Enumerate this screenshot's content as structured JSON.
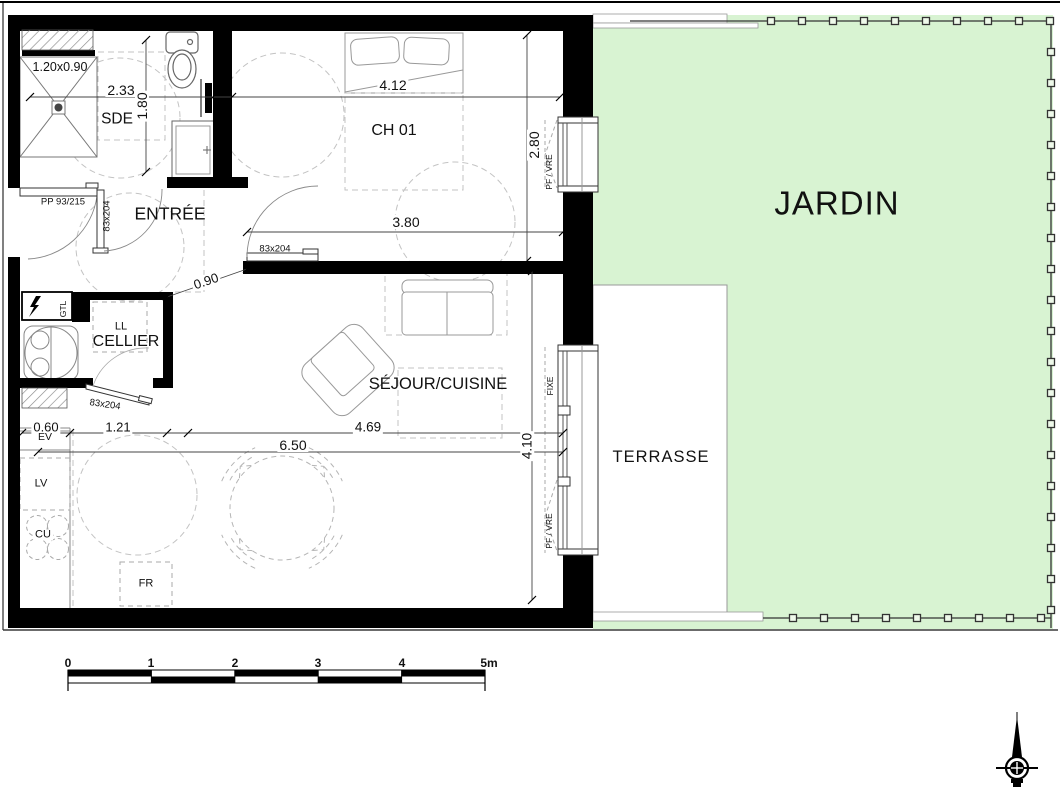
{
  "title": "Plan de logement",
  "rooms": [
    {
      "name": "room-sde",
      "text": "SDE",
      "x": 117,
      "y": 119,
      "size": 15.5
    },
    {
      "name": "room-entree",
      "text": "ENTRÉE",
      "x": 170,
      "y": 214,
      "size": 17.5
    },
    {
      "name": "room-ch01",
      "text": "CH 01",
      "x": 394,
      "y": 131,
      "size": 16
    },
    {
      "name": "room-cellier",
      "text": "CELLIER",
      "x": 126,
      "y": 342,
      "size": 16
    },
    {
      "name": "room-sejour-cuisine",
      "text": "SÉJOUR/CUISINE",
      "x": 438,
      "y": 384,
      "size": 16.5
    },
    {
      "name": "room-terrasse",
      "text": "TERRASSE",
      "x": 661,
      "y": 457,
      "size": 16.5,
      "ls": 1
    },
    {
      "name": "room-jardin",
      "text": "JARDIN",
      "x": 837,
      "y": 203,
      "size": 33,
      "ls": 1
    }
  ],
  "dim_labels": [
    {
      "name": "dim-shower",
      "text": "1.20x0.90",
      "x": 60,
      "y": 67,
      "size": 12.5
    },
    {
      "name": "dim-2-33",
      "text": "2.33",
      "x": 121,
      "y": 90,
      "size": 14,
      "bg": true
    },
    {
      "name": "dim-1-80",
      "text": "1.80",
      "x": 142,
      "y": 106,
      "rot": -90,
      "size": 14,
      "bg": true
    },
    {
      "name": "dim-4-12",
      "text": "4.12",
      "x": 393,
      "y": 85,
      "size": 14,
      "bg": true
    },
    {
      "name": "dim-2-80",
      "text": "2.80",
      "x": 534,
      "y": 145,
      "rot": -90,
      "size": 14,
      "bg": true
    },
    {
      "name": "dim-3-80",
      "text": "3.80",
      "x": 406,
      "y": 222,
      "size": 14,
      "bg": true
    },
    {
      "name": "dim-0-90",
      "text": "0.90",
      "x": 206,
      "y": 281,
      "rot": -19,
      "size": 13,
      "bg": true
    },
    {
      "name": "dim-0-60",
      "text": "0.60",
      "x": 46,
      "y": 427,
      "size": 13,
      "bg": true
    },
    {
      "name": "dim-1-21",
      "text": "1.21",
      "x": 118,
      "y": 427,
      "size": 13,
      "bg": true
    },
    {
      "name": "dim-4-69",
      "text": "4.69",
      "x": 368,
      "y": 427,
      "size": 13.5,
      "bg": true
    },
    {
      "name": "dim-6-50",
      "text": "6.50",
      "x": 293,
      "y": 445,
      "size": 14,
      "bg": true
    },
    {
      "name": "dim-4-10",
      "text": "4.10",
      "x": 527,
      "y": 446,
      "rot": -90,
      "size": 13.5,
      "bg": true
    }
  ],
  "door_labels": [
    {
      "name": "door-pp",
      "text": "PP 93/215",
      "x": 63,
      "y": 202,
      "size": 9.5
    },
    {
      "name": "door-sde",
      "text": "83x204",
      "x": 107,
      "y": 216,
      "rot": -90,
      "size": 9.5
    },
    {
      "name": "door-ch01",
      "text": "83x204",
      "x": 275,
      "y": 249,
      "size": 9.5
    },
    {
      "name": "door-cellier",
      "text": "83x204",
      "x": 105,
      "y": 405,
      "rot": 8,
      "size": 9.5
    }
  ],
  "fixture_labels": [
    {
      "name": "fixture-gtl",
      "text": "GTL",
      "x": 63,
      "y": 309,
      "rot": -90,
      "size": 8.5
    },
    {
      "name": "fixture-ll",
      "text": "LL",
      "x": 121,
      "y": 327,
      "size": 11
    },
    {
      "name": "fixture-ev",
      "text": "EV",
      "x": 45,
      "y": 437,
      "size": 10.5,
      "bg": true
    },
    {
      "name": "fixture-lv",
      "text": "LV",
      "x": 41,
      "y": 484,
      "size": 11
    },
    {
      "name": "fixture-cu",
      "text": "CU",
      "x": 43,
      "y": 535,
      "size": 11,
      "bg": true
    },
    {
      "name": "fixture-fr",
      "text": "FR",
      "x": 146,
      "y": 584,
      "size": 11
    }
  ],
  "window_labels": [
    {
      "name": "window-ch01-type",
      "text": "PF / VRE",
      "x": 549,
      "y": 172,
      "rot": -90,
      "size": 8.5
    },
    {
      "name": "window-sejour-fixe",
      "text": "FIXE",
      "x": 550,
      "y": 386,
      "rot": -90,
      "size": 8.5
    },
    {
      "name": "window-sejour-type",
      "text": "PF / VRE",
      "x": 549,
      "y": 531,
      "rot": -90,
      "size": 8.5
    }
  ],
  "scale_bar": {
    "x": 68,
    "y": 670,
    "meter_px": 83.4,
    "row_h": 6.5,
    "labels": [
      {
        "name": "scale-0",
        "text": "0",
        "x": 68,
        "y": 663
      },
      {
        "name": "scale-1",
        "text": "1",
        "x": 151,
        "y": 663
      },
      {
        "name": "scale-2",
        "text": "2",
        "x": 235,
        "y": 663
      },
      {
        "name": "scale-3",
        "text": "3",
        "x": 318,
        "y": 663
      },
      {
        "name": "scale-4",
        "text": "4",
        "x": 402,
        "y": 663
      },
      {
        "name": "scale-5m",
        "text": "5m",
        "x": 489,
        "y": 663
      }
    ]
  },
  "dimension_lines": [
    {
      "x1": 30,
      "y1": 97,
      "x2": 560,
      "y2": 97,
      "ticks": [
        [
          30,
          97
        ],
        [
          213,
          97
        ],
        [
          232,
          97
        ],
        [
          560,
          97
        ]
      ]
    },
    {
      "x1": 146,
      "y1": 40,
      "x2": 146,
      "y2": 172,
      "ticks": [
        [
          146,
          40
        ],
        [
          146,
          172
        ]
      ]
    },
    {
      "x1": 527,
      "y1": 35,
      "x2": 527,
      "y2": 261,
      "ticks": [
        [
          527,
          35
        ],
        [
          527,
          261
        ]
      ]
    },
    {
      "x1": 247,
      "y1": 232,
      "x2": 563,
      "y2": 232,
      "ticks": [
        [
          247,
          232
        ],
        [
          563,
          232
        ]
      ]
    },
    {
      "x1": 167,
      "y1": 297,
      "x2": 247,
      "y2": 269,
      "ticks": [
        [
          167,
          297
        ],
        [
          247,
          269
        ]
      ]
    },
    {
      "x1": 22,
      "y1": 433,
      "x2": 563,
      "y2": 433,
      "ticks": [
        [
          22,
          433
        ],
        [
          70,
          433
        ],
        [
          167,
          433
        ],
        [
          188,
          433
        ],
        [
          563,
          433
        ]
      ]
    },
    {
      "x1": 38,
      "y1": 452,
      "x2": 563,
      "y2": 452,
      "ticks": [
        [
          38,
          452
        ],
        [
          563,
          452
        ]
      ]
    },
    {
      "x1": 532,
      "y1": 271,
      "x2": 532,
      "y2": 600,
      "ticks": [
        [
          532,
          271
        ],
        [
          532,
          600
        ]
      ]
    }
  ],
  "fence": {
    "top": {
      "x1": 630,
      "y": 21,
      "x2": 1051,
      "posts_from": 771,
      "step": 31,
      "count": 10
    },
    "right": {
      "x": 1051,
      "y1": 21,
      "y2": 628,
      "posts_from": 52,
      "step": 31,
      "count": 19
    },
    "bottom": {
      "x1": 763,
      "y": 618,
      "x2": 1051,
      "posts_from": 793,
      "step": 31,
      "count": 9
    }
  },
  "table": {
    "cx": 282,
    "cy": 508,
    "r": 52,
    "chair_angles": [
      45,
      135,
      225,
      315
    ]
  },
  "burners": [
    [
      37,
      526
    ],
    [
      58,
      526
    ],
    [
      37,
      549
    ],
    [
      58,
      549
    ]
  ],
  "colors": {
    "jardin_fill": "#d8f3d2",
    "wall": "#000000",
    "furniture_line": "#999999",
    "dash_line": "#c3c3c3",
    "dim_line": "#444444",
    "fence_line": "#333333"
  }
}
